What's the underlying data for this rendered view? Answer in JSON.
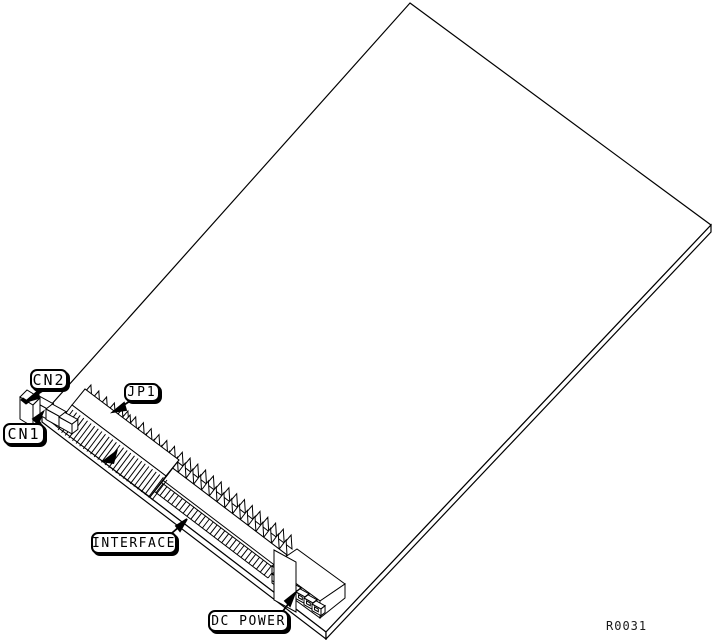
{
  "diagram": {
    "kind": "isometric circuit-board line drawing",
    "colors": {
      "line": "#000000",
      "background": "#ffffff"
    }
  },
  "labels": {
    "cn2": "CN2",
    "cn1": "CN1",
    "jp1": "JP1",
    "interface": "INTERFACE",
    "dc_power": "DC POWER"
  },
  "figure_ref": "R0031"
}
